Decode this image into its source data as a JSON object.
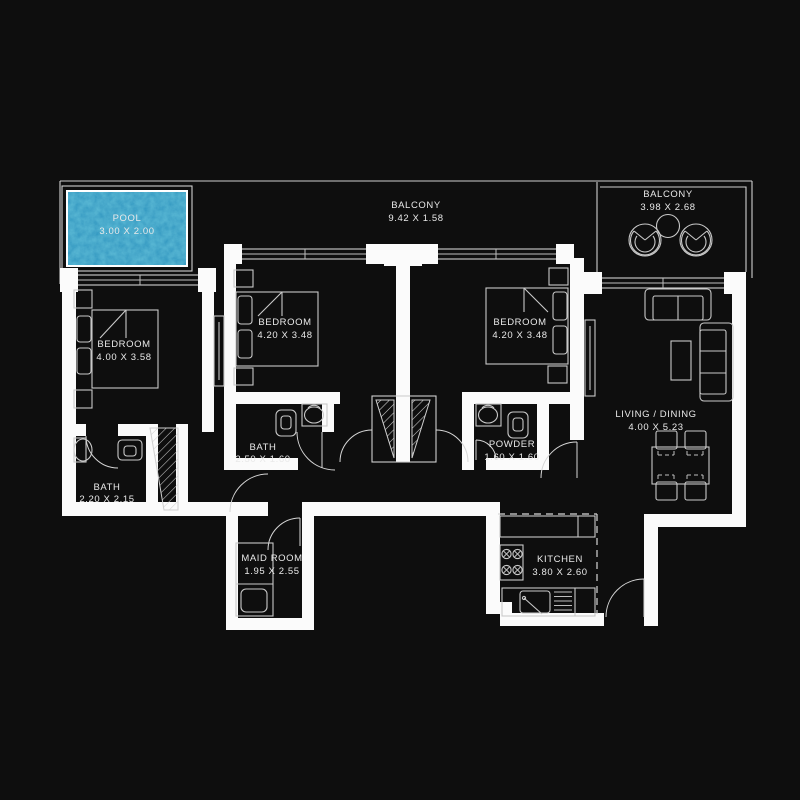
{
  "title": "Apartment Floor Plan",
  "colors": {
    "background": "#0e0e0e",
    "walls": "#fbfbfb",
    "lines": "#cfcfcf",
    "pool_water_base": "#56c3e4",
    "pool_water_shade": "#1d7ba6",
    "text": "#e9e9e9"
  },
  "rooms": [
    {
      "id": "pool",
      "name": "POOL",
      "dims": "3.00 X 2.00"
    },
    {
      "id": "balcony-main",
      "name": "BALCONY",
      "dims": "9.42 X 1.58"
    },
    {
      "id": "balcony-right",
      "name": "BALCONY",
      "dims": "3.98 X 2.68"
    },
    {
      "id": "bedroom-left",
      "name": "BEDROOM",
      "dims": "4.00 X 3.58"
    },
    {
      "id": "bedroom-middle",
      "name": "BEDROOM",
      "dims": "4.20 X 3.48"
    },
    {
      "id": "bedroom-right",
      "name": "BEDROOM",
      "dims": "4.20 X 3.48"
    },
    {
      "id": "bath-left",
      "name": "BATH",
      "dims": "2.20 X 2.15"
    },
    {
      "id": "bath-middle",
      "name": "BATH",
      "dims": "2.50 X 1.60"
    },
    {
      "id": "powder",
      "name": "POWDER",
      "dims": "1.60 X 1.60"
    },
    {
      "id": "maid-room",
      "name": "MAID ROOM",
      "dims": "1.95 X 2.55"
    },
    {
      "id": "kitchen",
      "name": "KITCHEN",
      "dims": "3.80 X 2.60"
    },
    {
      "id": "living-dining",
      "name": "LIVING / DINING",
      "dims": "4.00 X 5.23"
    }
  ]
}
